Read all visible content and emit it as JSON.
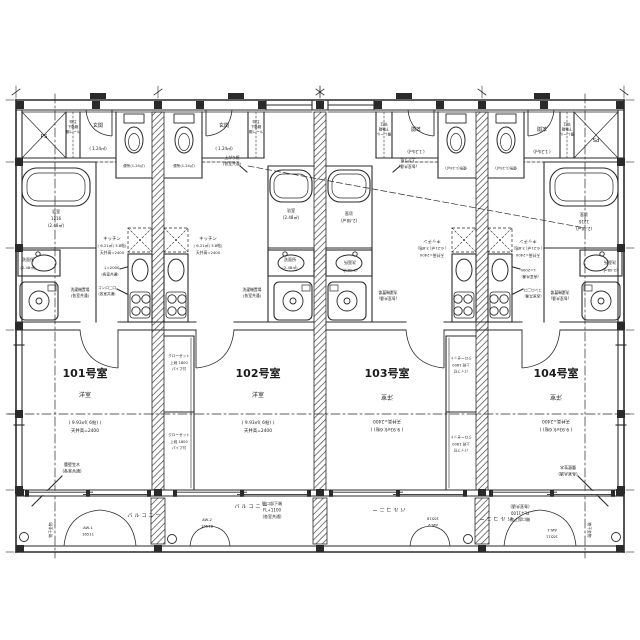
{
  "colors": {
    "line": "#2a2a2a",
    "background": "#ffffff"
  },
  "units": [
    {
      "number": "101号室",
      "room_type": "洋室",
      "room_area": "( 9.93㎡( 6帖) )",
      "ceiling": "天井高=2400"
    },
    {
      "number": "102号室",
      "room_type": "洋室",
      "room_area": "( 9.93㎡( 6帖) )",
      "ceiling": "天井高=2400"
    },
    {
      "number": "103号室",
      "room_type": "洋室",
      "room_area": "( 9.93㎡( 6帖) )",
      "ceiling": "天井高=2400"
    },
    {
      "number": "104号室",
      "room_type": "洋室",
      "room_area": "( 9.93㎡( 6帖) )",
      "ceiling": "天井高=2400"
    }
  ],
  "drawing": {
    "labels": [
      {
        "n": "u101-ps-label",
        "t": "PS",
        "x": 44,
        "y": 138,
        "s": 5.5
      },
      {
        "n": "u101-shoebox-line1",
        "t": "特注",
        "x": 73,
        "y": 123,
        "s": 3.6
      },
      {
        "n": "u101-shoebox-line2",
        "t": "下駄箱",
        "x": 73,
        "y": 128,
        "s": 3.6
      },
      {
        "n": "u101-shoebox-line3",
        "t": "棚レール",
        "x": 73,
        "y": 133,
        "s": 3.6
      },
      {
        "n": "u101-entry-label",
        "t": "玄関",
        "x": 98,
        "y": 127,
        "s": 5
      },
      {
        "n": "u101-entry-area",
        "t": "( 1.24㎡)",
        "x": 98,
        "y": 150,
        "s": 4
      },
      {
        "n": "u101-toilet-label",
        "t": "便所(1.24㎡)",
        "x": 134,
        "y": 167,
        "s": 3.6
      },
      {
        "n": "u102-toilet-label",
        "t": "便所(1.24㎡)",
        "x": 184,
        "y": 167,
        "s": 3.6
      },
      {
        "n": "u102-entry-label",
        "t": "玄関",
        "x": 224,
        "y": 127,
        "s": 5
      },
      {
        "n": "u102-entry-area",
        "t": "( 1.24㎡)",
        "x": 224,
        "y": 150,
        "s": 4
      },
      {
        "n": "u102-shoebox-line1",
        "t": "特注",
        "x": 256,
        "y": 123,
        "s": 3.6
      },
      {
        "n": "u102-shoebox-line2",
        "t": "下駄箱",
        "x": 256,
        "y": 128,
        "s": 3.6
      },
      {
        "n": "u102-shoebox-line3",
        "t": "棚レール",
        "x": 256,
        "y": 133,
        "s": 3.6
      },
      {
        "n": "agari-note-left-line1",
        "t": "上がり框",
        "x": 232,
        "y": 159,
        "s": 3.8
      },
      {
        "n": "agari-note-left-line2",
        "t": "(各室共通)",
        "x": 232,
        "y": 165,
        "s": 3.8
      },
      {
        "n": "u103-entry-label",
        "t": "玄関",
        "x": 416,
        "y": 127,
        "s": 5,
        "r": 180
      },
      {
        "n": "u103-entry-area",
        "t": "( 1.24㎡)",
        "x": 416,
        "y": 150,
        "s": 4,
        "r": 180
      },
      {
        "n": "u103-toilet-label",
        "t": "便所(1.24㎡)",
        "x": 456,
        "y": 167,
        "s": 3.6,
        "r": 180
      },
      {
        "n": "u103-shoebox-line1",
        "t": "特注",
        "x": 384,
        "y": 123,
        "s": 3.6,
        "r": 180
      },
      {
        "n": "u103-shoebox-line2",
        "t": "下駄箱",
        "x": 384,
        "y": 128,
        "s": 3.6,
        "r": 180
      },
      {
        "n": "u103-shoebox-line3",
        "t": "棚レール",
        "x": 384,
        "y": 133,
        "s": 3.6,
        "r": 180
      },
      {
        "n": "agari-note-right-line1",
        "t": "上がり框",
        "x": 408,
        "y": 159,
        "s": 3.8,
        "r": 180
      },
      {
        "n": "agari-note-right-line2",
        "t": "(各室共通)",
        "x": 408,
        "y": 165,
        "s": 3.8,
        "r": 180
      },
      {
        "n": "u104-toilet-label",
        "t": "便所(1.24㎡)",
        "x": 506,
        "y": 167,
        "s": 3.6,
        "r": 180
      },
      {
        "n": "u104-entry-label",
        "t": "玄関",
        "x": 542,
        "y": 127,
        "s": 5,
        "r": 180
      },
      {
        "n": "u104-entry-area",
        "t": "( 1.24㎡)",
        "x": 542,
        "y": 150,
        "s": 4,
        "r": 180
      },
      {
        "n": "u104-shoebox-line1",
        "t": "特注",
        "x": 567,
        "y": 123,
        "s": 3.6,
        "r": 180
      },
      {
        "n": "u104-shoebox-line2",
        "t": "下駄箱",
        "x": 567,
        "y": 128,
        "s": 3.6,
        "r": 180
      },
      {
        "n": "u104-shoebox-line3",
        "t": "棚レール",
        "x": 567,
        "y": 133,
        "s": 3.6,
        "r": 180
      },
      {
        "n": "u104-ps-label",
        "t": "PS",
        "x": 596,
        "y": 138,
        "s": 5.5,
        "r": 180
      },
      {
        "n": "u101-bath-name",
        "t": "浴室",
        "x": 56,
        "y": 213,
        "s": 4.2
      },
      {
        "n": "u101-bath-size",
        "t": "1216",
        "x": 56,
        "y": 220,
        "s": 4
      },
      {
        "n": "u101-bath-area",
        "t": "(2.48㎡)",
        "x": 56,
        "y": 227,
        "s": 4
      },
      {
        "n": "u102-bath-name",
        "t": "浴室",
        "x": 291,
        "y": 212,
        "s": 4.2
      },
      {
        "n": "u102-bath-area",
        "t": "(2.48㎡)",
        "x": 291,
        "y": 219,
        "s": 4
      },
      {
        "n": "u103-bath-name",
        "t": "浴室",
        "x": 349,
        "y": 212,
        "s": 4.2,
        "r": 180
      },
      {
        "n": "u103-bath-area",
        "t": "(2.48㎡)",
        "x": 349,
        "y": 219,
        "s": 4,
        "r": 180
      },
      {
        "n": "u104-bath-name",
        "t": "浴室",
        "x": 584,
        "y": 213,
        "s": 4.2,
        "r": 180
      },
      {
        "n": "u104-bath-size",
        "t": "1216",
        "x": 584,
        "y": 220,
        "s": 4,
        "r": 180
      },
      {
        "n": "u104-bath-area",
        "t": "(2.48㎡)",
        "x": 584,
        "y": 227,
        "s": 4,
        "r": 180
      },
      {
        "n": "u101-wash-name",
        "t": "洗面所",
        "x": 28,
        "y": 261,
        "s": 4
      },
      {
        "n": "u101-wash-area",
        "t": "(2.48㎡)",
        "x": 28,
        "y": 269,
        "s": 3.8
      },
      {
        "n": "u102-wash-name",
        "t": "洗面所",
        "x": 290,
        "y": 261,
        "s": 4
      },
      {
        "n": "u102-wash-area",
        "t": "(2.48㎡)",
        "x": 290,
        "y": 269,
        "s": 3.8
      },
      {
        "n": "u103-wash-name",
        "t": "洗面所",
        "x": 350,
        "y": 261,
        "s": 4,
        "r": 180
      },
      {
        "n": "u103-wash-area",
        "t": "(2.48㎡)",
        "x": 350,
        "y": 269,
        "s": 3.8,
        "r": 180
      },
      {
        "n": "u104-wash-name",
        "t": "洗面所",
        "x": 610,
        "y": 261,
        "s": 4,
        "r": 180
      },
      {
        "n": "u104-wash-area",
        "t": "(2.48㎡)",
        "x": 610,
        "y": 269,
        "s": 3.8,
        "r": 180
      },
      {
        "n": "u101-laundry-line1",
        "t": "洗濯機置場",
        "x": 80,
        "y": 291,
        "s": 3.8
      },
      {
        "n": "u101-laundry-line2",
        "t": "(各室共通)",
        "x": 80,
        "y": 297,
        "s": 3.8
      },
      {
        "n": "u102-laundry-line1",
        "t": "洗濯機置場",
        "x": 252,
        "y": 291,
        "s": 3.8
      },
      {
        "n": "u102-laundry-line2",
        "t": "(各室共通)",
        "x": 252,
        "y": 297,
        "s": 3.8
      },
      {
        "n": "u103-laundry-line1",
        "t": "洗濯機置場",
        "x": 388,
        "y": 291,
        "s": 3.8,
        "r": 180
      },
      {
        "n": "u103-laundry-line2",
        "t": "(各室共通)",
        "x": 388,
        "y": 297,
        "s": 3.8,
        "r": 180
      },
      {
        "n": "u104-laundry-line1",
        "t": "洗濯機置場",
        "x": 560,
        "y": 291,
        "s": 3.8,
        "r": 180
      },
      {
        "n": "u104-laundry-line2",
        "t": "(各室共通)",
        "x": 560,
        "y": 297,
        "s": 3.8,
        "r": 180
      },
      {
        "n": "u101-kitchen-name",
        "t": "キッチン",
        "x": 112,
        "y": 240,
        "s": 4.4
      },
      {
        "n": "u101-kitchen-area",
        "t": "( 6.21㎡( 3.8帖)",
        "x": 112,
        "y": 247,
        "s": 3.8
      },
      {
        "n": "u101-kitchen-ceiling",
        "t": "天井高=2400",
        "x": 112,
        "y": 254,
        "s": 3.8
      },
      {
        "n": "u102-kitchen-name",
        "t": "キッチン",
        "x": 208,
        "y": 240,
        "s": 4.4
      },
      {
        "n": "u102-kitchen-area",
        "t": "( 6.21㎡( 3.8帖)",
        "x": 208,
        "y": 247,
        "s": 3.8
      },
      {
        "n": "u102-kitchen-ceiling",
        "t": "天井高=2400",
        "x": 208,
        "y": 254,
        "s": 3.8
      },
      {
        "n": "u103-kitchen-name",
        "t": "キッチン",
        "x": 432,
        "y": 240,
        "s": 4.4,
        "r": 180
      },
      {
        "n": "u103-kitchen-area",
        "t": "( 6.21㎡( 3.8帖)",
        "x": 432,
        "y": 247,
        "s": 3.8,
        "r": 180
      },
      {
        "n": "u103-kitchen-ceiling",
        "t": "天井高=2400",
        "x": 432,
        "y": 254,
        "s": 3.8,
        "r": 180
      },
      {
        "n": "u104-kitchen-name",
        "t": "キッチン",
        "x": 528,
        "y": 240,
        "s": 4.4,
        "r": 180
      },
      {
        "n": "u104-kitchen-area",
        "t": "( 6.21㎡( 3.8帖)",
        "x": 528,
        "y": 247,
        "s": 3.8,
        "r": 180
      },
      {
        "n": "u104-kitchen-ceiling",
        "t": "天井高=2400",
        "x": 528,
        "y": 254,
        "s": 3.8,
        "r": 180
      },
      {
        "n": "counter-left-length",
        "t": "L=2000",
        "x": 112,
        "y": 269,
        "s": 3.8
      },
      {
        "n": "counter-left-note",
        "t": "(各室共通)",
        "x": 110,
        "y": 275.5,
        "s": 3.6
      },
      {
        "n": "stove-left-line1",
        "t": "コンロ二口",
        "x": 107,
        "y": 289,
        "s": 3.6
      },
      {
        "n": "stove-left-line2",
        "t": "(各室共通)",
        "x": 107,
        "y": 295,
        "s": 3.6
      },
      {
        "n": "counter-right-length",
        "t": "L=2000",
        "x": 528,
        "y": 269,
        "s": 3.8,
        "r": 180
      },
      {
        "n": "counter-right-note",
        "t": "(各室共通)",
        "x": 530,
        "y": 275.5,
        "s": 3.6,
        "r": 180
      },
      {
        "n": "stove-right-line1",
        "t": "コンロ二口",
        "x": 533,
        "y": 289,
        "s": 3.6,
        "r": 180
      },
      {
        "n": "stove-right-line2",
        "t": "(各室共通)",
        "x": 533,
        "y": 295,
        "s": 3.6,
        "r": 180
      },
      {
        "n": "unit101-number",
        "t": "101号室",
        "x": 85,
        "y": 377,
        "s": 11,
        "b": 1
      },
      {
        "n": "unit101-room-type",
        "t": "洋室",
        "x": 85,
        "y": 397,
        "s": 6
      },
      {
        "n": "unit101-room-area",
        "t": "( 9.93㎡( 6帖) )",
        "x": 85,
        "y": 424,
        "s": 4.4
      },
      {
        "n": "unit101-room-ceiling",
        "t": "天井高=2400",
        "x": 85,
        "y": 432,
        "s": 4.4
      },
      {
        "n": "unit102-number",
        "t": "102号室",
        "x": 258,
        "y": 377,
        "s": 11,
        "b": 1
      },
      {
        "n": "unit102-room-type",
        "t": "洋室",
        "x": 258,
        "y": 397,
        "s": 6
      },
      {
        "n": "unit102-room-area",
        "t": "( 9.93㎡( 6帖) )",
        "x": 258,
        "y": 424,
        "s": 4.4
      },
      {
        "n": "unit102-room-ceiling",
        "t": "天井高=2400",
        "x": 258,
        "y": 432,
        "s": 4.4
      },
      {
        "n": "unit103-number",
        "t": "103号室",
        "x": 387,
        "y": 377,
        "s": 11,
        "b": 1
      },
      {
        "n": "unit103-room-type",
        "t": "洋室",
        "x": 387,
        "y": 395,
        "s": 6,
        "r": 180
      },
      {
        "n": "unit103-room-area",
        "t": "( 9.93㎡( 6帖) )",
        "x": 387,
        "y": 428,
        "s": 4.4,
        "r": 180
      },
      {
        "n": "unit103-room-ceiling",
        "t": "天井高=2400",
        "x": 387,
        "y": 420,
        "s": 4.4,
        "r": 180
      },
      {
        "n": "unit104-number",
        "t": "104号室",
        "x": 556,
        "y": 377,
        "s": 11,
        "b": 1
      },
      {
        "n": "unit104-room-type",
        "t": "洋室",
        "x": 556,
        "y": 395,
        "s": 6,
        "r": 180
      },
      {
        "n": "unit104-room-area",
        "t": "( 9.93㎡( 6帖) )",
        "x": 556,
        "y": 428,
        "s": 4.4,
        "r": 180
      },
      {
        "n": "unit104-room-ceiling",
        "t": "天井高=2400",
        "x": 556,
        "y": 420,
        "s": 4.4,
        "r": 180
      },
      {
        "n": "closet-left-upper-line1",
        "t": "クローゼット",
        "x": 179,
        "y": 357,
        "s": 3.6
      },
      {
        "n": "closet-left-upper-line2",
        "t": "上段 1800",
        "x": 179,
        "y": 364,
        "s": 3.6
      },
      {
        "n": "closet-left-upper-line3",
        "t": "パイプ付",
        "x": 179,
        "y": 370,
        "s": 3.6
      },
      {
        "n": "closet-left-lower-line1",
        "t": "クローゼット",
        "x": 179,
        "y": 436,
        "s": 3.6
      },
      {
        "n": "closet-left-lower-line2",
        "t": "上段 1800",
        "x": 179,
        "y": 443,
        "s": 3.6
      },
      {
        "n": "closet-left-lower-line3",
        "t": "パイプ付",
        "x": 179,
        "y": 449,
        "s": 3.6
      },
      {
        "n": "closet-right-upper-line1",
        "t": "クローゼット",
        "x": 461,
        "y": 357,
        "s": 3.6,
        "r": 180
      },
      {
        "n": "closet-right-upper-line2",
        "t": "上段 1800",
        "x": 461,
        "y": 364,
        "s": 3.6,
        "r": 180
      },
      {
        "n": "closet-right-upper-line3",
        "t": "パイプ付",
        "x": 461,
        "y": 370,
        "s": 3.6,
        "r": 180
      },
      {
        "n": "closet-right-lower-line1",
        "t": "クローゼット",
        "x": 461,
        "y": 436,
        "s": 3.6,
        "r": 180
      },
      {
        "n": "closet-right-lower-line2",
        "t": "上段 1800",
        "x": 461,
        "y": 443,
        "s": 3.6,
        "r": 180
      },
      {
        "n": "closet-right-lower-line3",
        "t": "パイプ付",
        "x": 461,
        "y": 449,
        "s": 3.6,
        "r": 180
      },
      {
        "n": "balcony-label-1",
        "t": "バルコニー",
        "x": 145,
        "y": 517,
        "s": 5,
        "sp": 2
      },
      {
        "n": "balcony-label-2",
        "t": "バルコニー",
        "x": 252,
        "y": 508,
        "s": 5,
        "sp": 2
      },
      {
        "n": "balcony-label-3",
        "t": "バルコニー",
        "x": 388,
        "y": 508,
        "s": 5,
        "sp": 2,
        "r": 180
      },
      {
        "n": "balcony-label-4",
        "t": "バルコニー",
        "x": 495,
        "y": 517,
        "s": 5,
        "sp": 2,
        "r": 180
      },
      {
        "n": "sill-note-left-line1",
        "t": "開口部下端",
        "x": 272,
        "y": 505,
        "s": 4
      },
      {
        "n": "sill-note-left-line2",
        "t": "FL+1100",
        "x": 272,
        "y": 511.5,
        "s": 4
      },
      {
        "n": "sill-note-left-line3",
        "t": "(各室共通)",
        "x": 272,
        "y": 518,
        "s": 4
      },
      {
        "n": "sill-note-right-line1",
        "t": "開口部下端",
        "x": 520,
        "y": 518,
        "s": 4,
        "r": 180
      },
      {
        "n": "sill-note-right-line2",
        "t": "FL+1100",
        "x": 520,
        "y": 511.5,
        "s": 4,
        "r": 180
      },
      {
        "n": "sill-note-right-line3",
        "t": "(各室共通)",
        "x": 520,
        "y": 505,
        "s": 4,
        "r": 180
      },
      {
        "n": "window-tag-aw1-left",
        "t": "AW-1",
        "x": 88,
        "y": 529,
        "s": 3.8
      },
      {
        "n": "window-tag-aw1-left-size",
        "t": "16511",
        "x": 88,
        "y": 535.5,
        "s": 3.8
      },
      {
        "n": "window-tag-aw2-left",
        "t": "AW-2",
        "x": 207,
        "y": 521,
        "s": 3.8
      },
      {
        "n": "window-tag-aw2-left-size",
        "t": "16518",
        "x": 207,
        "y": 527.5,
        "s": 3.8
      },
      {
        "n": "window-tag-aw2-right",
        "t": "AW-2",
        "x": 433,
        "y": 524,
        "s": 3.8,
        "r": 180
      },
      {
        "n": "window-tag-aw2-right-size",
        "t": "16518",
        "x": 433,
        "y": 517.5,
        "s": 3.8,
        "r": 180
      },
      {
        "n": "window-tag-aw1-right",
        "t": "AW-1",
        "x": 552,
        "y": 529,
        "s": 3.8,
        "r": 180
      },
      {
        "n": "window-tag-aw1-right-size",
        "t": "16511",
        "x": 552,
        "y": 535.5,
        "s": 3.8,
        "r": 180
      },
      {
        "n": "parapet-note-left-line1",
        "t": "腰壁笠木",
        "x": 72,
        "y": 466,
        "s": 4
      },
      {
        "n": "parapet-note-left-line2",
        "t": "(各室共通)",
        "x": 72,
        "y": 472.5,
        "s": 4
      },
      {
        "n": "parapet-note-right-line1",
        "t": "腰壁笠木",
        "x": 568,
        "y": 466,
        "s": 4,
        "r": 180
      },
      {
        "n": "parapet-note-right-line2",
        "t": "(各室共通)",
        "x": 568,
        "y": 472.5,
        "s": 4,
        "r": 180
      },
      {
        "n": "laundry-pole-note-left",
        "t": "物干金物",
        "x": 52,
        "y": 530,
        "s": 3.8,
        "r": -90
      },
      {
        "n": "laundry-pole-note-right",
        "t": "物干金物",
        "x": 588,
        "y": 530,
        "s": 3.8,
        "r": 90
      }
    ]
  }
}
